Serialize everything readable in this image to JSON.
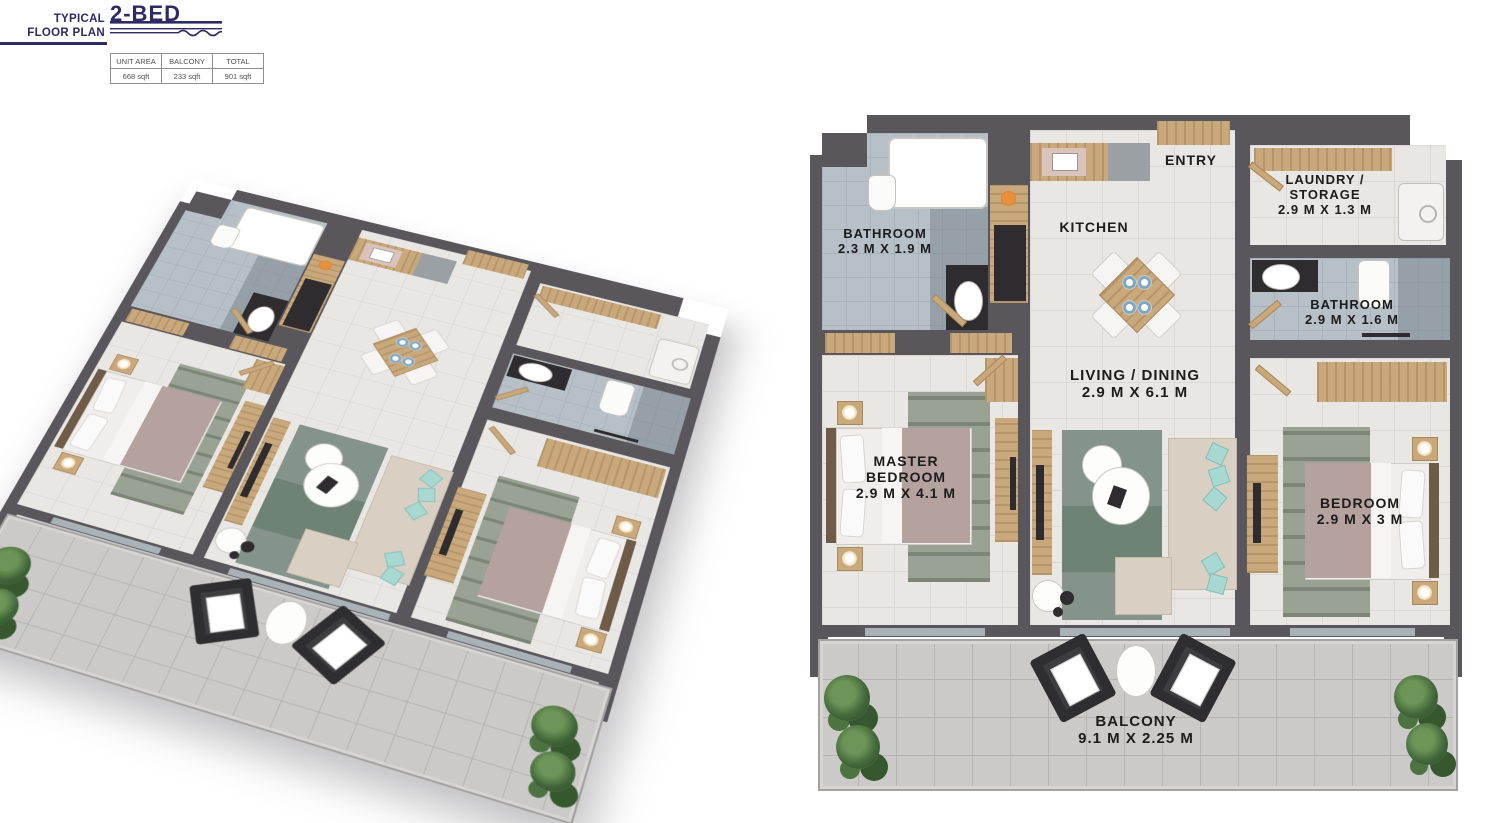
{
  "header": {
    "eyebrow_line1": "TYPICAL",
    "eyebrow_line2": "FLOOR PLAN",
    "title": "2-BED"
  },
  "area_table": {
    "columns": [
      "UNIT AREA",
      "BALCONY",
      "TOTAL"
    ],
    "values": [
      "668 sqft",
      "233 sqft",
      "901 sqft"
    ]
  },
  "floor_plan": {
    "rooms": {
      "bathroom1": {
        "name": "BATHROOM",
        "dims": "2.3 M X 1.9 M"
      },
      "kitchen": {
        "name": "KITCHEN"
      },
      "entry": {
        "name": "ENTRY"
      },
      "laundry": {
        "name_line1": "LAUNDRY /",
        "name_line2": "STORAGE",
        "dims": "2.9 M X 1.3 M"
      },
      "bathroom2": {
        "name": "BATHROOM",
        "dims": "2.9 M X 1.6 M"
      },
      "living": {
        "name": "LIVING / DINING",
        "dims": "2.9 M X 6.1 M"
      },
      "master": {
        "name_line1": "MASTER",
        "name_line2": "BEDROOM",
        "dims": "2.9 M X 4.1 M"
      },
      "bedroom": {
        "name": "BEDROOM",
        "dims": "2.9 M X 3 M"
      },
      "balcony": {
        "name": "BALCONY",
        "dims": "9.1 M X 2.25 M"
      }
    }
  },
  "colors": {
    "accent_navy": "#2d2a64",
    "wall_gray": "#59575c",
    "wood": "#c9a97c",
    "bath_floor": "#b7c0c7",
    "floor": "#e9e7e4",
    "balcony_tile": "#cbcac8",
    "label_text": "#1c1c1c"
  }
}
